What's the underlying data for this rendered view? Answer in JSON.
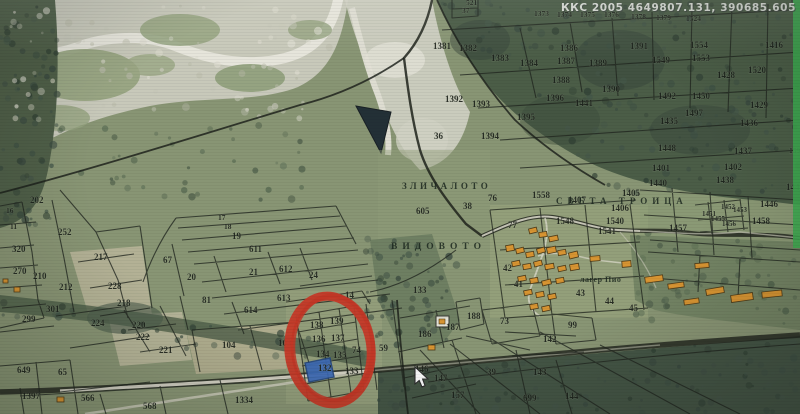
{
  "screen": {
    "coords_readout": "ККС 2005 4649807.131, 390685.605"
  },
  "map": {
    "highlighted_parcel": {
      "number": "132",
      "fill": "#2e63bd",
      "border": "#173e80"
    },
    "annotation": {
      "type": "hand-drawn-circle",
      "color": "#d32d18"
    },
    "cursor": {
      "x": 415,
      "y": 367
    },
    "area_labels": [
      {
        "text": "ЗЛИЧАЛОТО",
        "x": 402,
        "y": 189,
        "ls": 3.5,
        "size": 9
      },
      {
        "text": "ВИДОВОТО",
        "x": 391,
        "y": 249,
        "ls": 5,
        "size": 9.5
      },
      {
        "text": "СВЕТА  ТРОИЦА",
        "x": 556,
        "y": 204,
        "ls": 5,
        "size": 9
      },
      {
        "text": "лагер Пио",
        "x": 580,
        "y": 282,
        "ls": 0.5,
        "size": 8
      }
    ],
    "parcel_labels": [
      {
        "t": "521",
        "x": 466,
        "y": 5,
        "s": 7.5
      },
      {
        "t": "37",
        "x": 462,
        "y": 13,
        "s": 7.5
      },
      {
        "t": "1373",
        "x": 534,
        "y": 16,
        "s": 7.5
      },
      {
        "t": "1374",
        "x": 557,
        "y": 17,
        "s": 7.5
      },
      {
        "t": "1375",
        "x": 580,
        "y": 17,
        "s": 7.5
      },
      {
        "t": "1376",
        "x": 604,
        "y": 17,
        "s": 7.5
      },
      {
        "t": "1378",
        "x": 631,
        "y": 19,
        "s": 7.5
      },
      {
        "t": "1379",
        "x": 656,
        "y": 20,
        "s": 7.5
      },
      {
        "t": "1524",
        "x": 686,
        "y": 21,
        "s": 7.5
      },
      {
        "t": "1381",
        "x": 433,
        "y": 49
      },
      {
        "t": "1382",
        "x": 459,
        "y": 51
      },
      {
        "t": "1383",
        "x": 491,
        "y": 61
      },
      {
        "t": "1384",
        "x": 520,
        "y": 66
      },
      {
        "t": "1386",
        "x": 560,
        "y": 51
      },
      {
        "t": "1387",
        "x": 557,
        "y": 64
      },
      {
        "t": "1389",
        "x": 589,
        "y": 66
      },
      {
        "t": "1388",
        "x": 552,
        "y": 83
      },
      {
        "t": "1390",
        "x": 602,
        "y": 92
      },
      {
        "t": "1391",
        "x": 630,
        "y": 49
      },
      {
        "t": "1549",
        "x": 652,
        "y": 63
      },
      {
        "t": "1554",
        "x": 690,
        "y": 48
      },
      {
        "t": "1553",
        "x": 692,
        "y": 61
      },
      {
        "t": "1416",
        "x": 765,
        "y": 48
      },
      {
        "t": "1428",
        "x": 717,
        "y": 78
      },
      {
        "t": "1520",
        "x": 748,
        "y": 73
      },
      {
        "t": "1492",
        "x": 658,
        "y": 99
      },
      {
        "t": "1450",
        "x": 692,
        "y": 99
      },
      {
        "t": "1429",
        "x": 750,
        "y": 108
      },
      {
        "t": "1497",
        "x": 685,
        "y": 116
      },
      {
        "t": "1435",
        "x": 660,
        "y": 124
      },
      {
        "t": "1436",
        "x": 740,
        "y": 126
      },
      {
        "t": "1448",
        "x": 658,
        "y": 151
      },
      {
        "t": "1437",
        "x": 734,
        "y": 154
      },
      {
        "t": "1591",
        "x": 789,
        "y": 153,
        "s": 7.5
      },
      {
        "t": "1401",
        "x": 652,
        "y": 171
      },
      {
        "t": "1402",
        "x": 724,
        "y": 170
      },
      {
        "t": "1440",
        "x": 649,
        "y": 186
      },
      {
        "t": "1438",
        "x": 716,
        "y": 183
      },
      {
        "t": "1444",
        "x": 786,
        "y": 190
      },
      {
        "t": "1446",
        "x": 760,
        "y": 207
      },
      {
        "t": "1452",
        "x": 721,
        "y": 209,
        "s": 7
      },
      {
        "t": "1451",
        "x": 702,
        "y": 216,
        "s": 7
      },
      {
        "t": "1453",
        "x": 733,
        "y": 212,
        "s": 7
      },
      {
        "t": "1455",
        "x": 711,
        "y": 221,
        "s": 7
      },
      {
        "t": "1456",
        "x": 722,
        "y": 226,
        "s": 7
      },
      {
        "t": "1458",
        "x": 752,
        "y": 224
      },
      {
        "t": "1457",
        "x": 669,
        "y": 231
      },
      {
        "t": "1392",
        "x": 445,
        "y": 102
      },
      {
        "t": "1393",
        "x": 472,
        "y": 107
      },
      {
        "t": "1396",
        "x": 546,
        "y": 101
      },
      {
        "t": "1441",
        "x": 575,
        "y": 106
      },
      {
        "t": "1395",
        "x": 517,
        "y": 120
      },
      {
        "t": "1394",
        "x": 481,
        "y": 139
      },
      {
        "t": "36",
        "x": 434,
        "y": 139
      },
      {
        "t": "605",
        "x": 416,
        "y": 214
      },
      {
        "t": "38",
        "x": 463,
        "y": 209
      },
      {
        "t": "76",
        "x": 488,
        "y": 201
      },
      {
        "t": "77",
        "x": 508,
        "y": 228
      },
      {
        "t": "1558",
        "x": 532,
        "y": 198
      },
      {
        "t": "1407",
        "x": 568,
        "y": 203
      },
      {
        "t": "1405",
        "x": 622,
        "y": 196
      },
      {
        "t": "1406",
        "x": 611,
        "y": 211
      },
      {
        "t": "1540",
        "x": 606,
        "y": 224
      },
      {
        "t": "1541",
        "x": 598,
        "y": 234
      },
      {
        "t": "1548",
        "x": 556,
        "y": 224
      },
      {
        "t": "42",
        "x": 503,
        "y": 271
      },
      {
        "t": "41",
        "x": 514,
        "y": 287
      },
      {
        "t": "43",
        "x": 576,
        "y": 296
      },
      {
        "t": "44",
        "x": 605,
        "y": 304
      },
      {
        "t": "45",
        "x": 629,
        "y": 311
      },
      {
        "t": "17",
        "x": 218,
        "y": 220,
        "s": 7.5
      },
      {
        "t": "18",
        "x": 224,
        "y": 229,
        "s": 7.5
      },
      {
        "t": "19",
        "x": 232,
        "y": 239
      },
      {
        "t": "611",
        "x": 249,
        "y": 252
      },
      {
        "t": "67",
        "x": 163,
        "y": 263
      },
      {
        "t": "20",
        "x": 187,
        "y": 280
      },
      {
        "t": "21",
        "x": 249,
        "y": 275
      },
      {
        "t": "612",
        "x": 279,
        "y": 272
      },
      {
        "t": "24",
        "x": 309,
        "y": 278
      },
      {
        "t": "81",
        "x": 202,
        "y": 303
      },
      {
        "t": "613",
        "x": 277,
        "y": 301
      },
      {
        "t": "614",
        "x": 244,
        "y": 313
      },
      {
        "t": "16",
        "x": 6,
        "y": 213,
        "s": 7.5
      },
      {
        "t": "11",
        "x": 10,
        "y": 229,
        "s": 7.5
      },
      {
        "t": "202",
        "x": 30,
        "y": 203
      },
      {
        "t": "252",
        "x": 58,
        "y": 235
      },
      {
        "t": "320",
        "x": 12,
        "y": 252
      },
      {
        "t": "270",
        "x": 13,
        "y": 274
      },
      {
        "t": "210",
        "x": 33,
        "y": 279
      },
      {
        "t": "212",
        "x": 59,
        "y": 290
      },
      {
        "t": "217",
        "x": 94,
        "y": 260
      },
      {
        "t": "228",
        "x": 108,
        "y": 289
      },
      {
        "t": "218",
        "x": 117,
        "y": 306
      },
      {
        "t": "301",
        "x": 46,
        "y": 312
      },
      {
        "t": "299",
        "x": 22,
        "y": 322
      },
      {
        "t": "224",
        "x": 91,
        "y": 326
      },
      {
        "t": "220",
        "x": 132,
        "y": 328
      },
      {
        "t": "222",
        "x": 136,
        "y": 340
      },
      {
        "t": "221",
        "x": 159,
        "y": 353
      },
      {
        "t": "104",
        "x": 222,
        "y": 348
      },
      {
        "t": "103",
        "x": 278,
        "y": 346
      },
      {
        "t": "649",
        "x": 17,
        "y": 373
      },
      {
        "t": "65",
        "x": 58,
        "y": 375
      },
      {
        "t": "1397",
        "x": 22,
        "y": 399
      },
      {
        "t": "566",
        "x": 81,
        "y": 401
      },
      {
        "t": "568",
        "x": 143,
        "y": 409
      },
      {
        "t": "1334",
        "x": 235,
        "y": 403
      },
      {
        "t": "14",
        "x": 345,
        "y": 298
      },
      {
        "t": "133",
        "x": 413,
        "y": 293
      },
      {
        "t": "138",
        "x": 310,
        "y": 328
      },
      {
        "t": "139",
        "x": 330,
        "y": 324
      },
      {
        "t": "136",
        "x": 312,
        "y": 342
      },
      {
        "t": "137",
        "x": 331,
        "y": 341
      },
      {
        "t": "134",
        "x": 316,
        "y": 357
      },
      {
        "t": "135",
        "x": 333,
        "y": 358
      },
      {
        "t": "74",
        "x": 352,
        "y": 353
      },
      {
        "t": "59",
        "x": 379,
        "y": 351
      },
      {
        "t": "132",
        "x": 318,
        "y": 371
      },
      {
        "t": "133",
        "x": 345,
        "y": 374
      },
      {
        "t": "186",
        "x": 418,
        "y": 337
      },
      {
        "t": "187",
        "x": 446,
        "y": 330
      },
      {
        "t": "188",
        "x": 467,
        "y": 319
      },
      {
        "t": "73",
        "x": 500,
        "y": 324
      },
      {
        "t": "99",
        "x": 568,
        "y": 328
      },
      {
        "t": "142",
        "x": 543,
        "y": 342
      },
      {
        "t": "146",
        "x": 415,
        "y": 372
      },
      {
        "t": "147",
        "x": 434,
        "y": 381
      },
      {
        "t": "157",
        "x": 451,
        "y": 398
      },
      {
        "t": "39",
        "x": 487,
        "y": 375
      },
      {
        "t": "143",
        "x": 533,
        "y": 375
      },
      {
        "t": "699",
        "x": 523,
        "y": 401
      },
      {
        "t": "144",
        "x": 565,
        "y": 399
      }
    ],
    "buildings": [
      [
        529,
        228,
        8,
        5,
        -14
      ],
      [
        539,
        232,
        8,
        5,
        -8
      ],
      [
        549,
        236,
        9,
        5,
        -12
      ],
      [
        506,
        245,
        8,
        6,
        -10
      ],
      [
        516,
        248,
        8,
        5,
        -14
      ],
      [
        526,
        252,
        8,
        5,
        -10
      ],
      [
        537,
        248,
        8,
        5,
        -16
      ],
      [
        547,
        247,
        9,
        6,
        -12
      ],
      [
        558,
        250,
        8,
        5,
        -10
      ],
      [
        569,
        252,
        9,
        6,
        -14
      ],
      [
        512,
        261,
        8,
        5,
        -12
      ],
      [
        523,
        264,
        8,
        5,
        -10
      ],
      [
        534,
        261,
        8,
        5,
        -15
      ],
      [
        545,
        264,
        9,
        5,
        -10
      ],
      [
        558,
        266,
        8,
        5,
        -12
      ],
      [
        570,
        264,
        9,
        6,
        -10
      ],
      [
        518,
        276,
        8,
        5,
        -12
      ],
      [
        530,
        278,
        8,
        5,
        -10
      ],
      [
        542,
        280,
        9,
        5,
        -14
      ],
      [
        556,
        278,
        8,
        5,
        -10
      ],
      [
        524,
        290,
        8,
        5,
        -12
      ],
      [
        536,
        292,
        8,
        5,
        -10
      ],
      [
        548,
        294,
        8,
        5,
        -12
      ],
      [
        530,
        304,
        8,
        5,
        -10
      ],
      [
        542,
        306,
        8,
        5,
        -12
      ],
      [
        590,
        256,
        10,
        5,
        -5
      ],
      [
        622,
        261,
        9,
        6,
        -5
      ],
      [
        645,
        276,
        18,
        6,
        -8
      ],
      [
        668,
        283,
        16,
        5,
        -8
      ],
      [
        695,
        263,
        14,
        5,
        -5
      ],
      [
        706,
        288,
        18,
        6,
        -10
      ],
      [
        731,
        294,
        22,
        7,
        -8
      ],
      [
        684,
        299,
        15,
        5,
        -8
      ],
      [
        762,
        291,
        20,
        6,
        -6
      ],
      [
        428,
        345,
        7,
        5,
        0
      ],
      [
        57,
        397,
        7,
        5,
        0
      ],
      [
        14,
        287,
        6,
        5,
        0
      ],
      [
        3,
        279,
        5,
        4,
        0
      ]
    ],
    "special_marker": {
      "x": 436,
      "y": 316,
      "w": 13,
      "h": 11
    },
    "colors": {
      "building_fill": "#e2921e",
      "building_border": "#4a3208",
      "annotation_red": "#d32d18",
      "highlight_blue": "#2e63bd",
      "screen_edge_green": "#2fae44"
    }
  }
}
